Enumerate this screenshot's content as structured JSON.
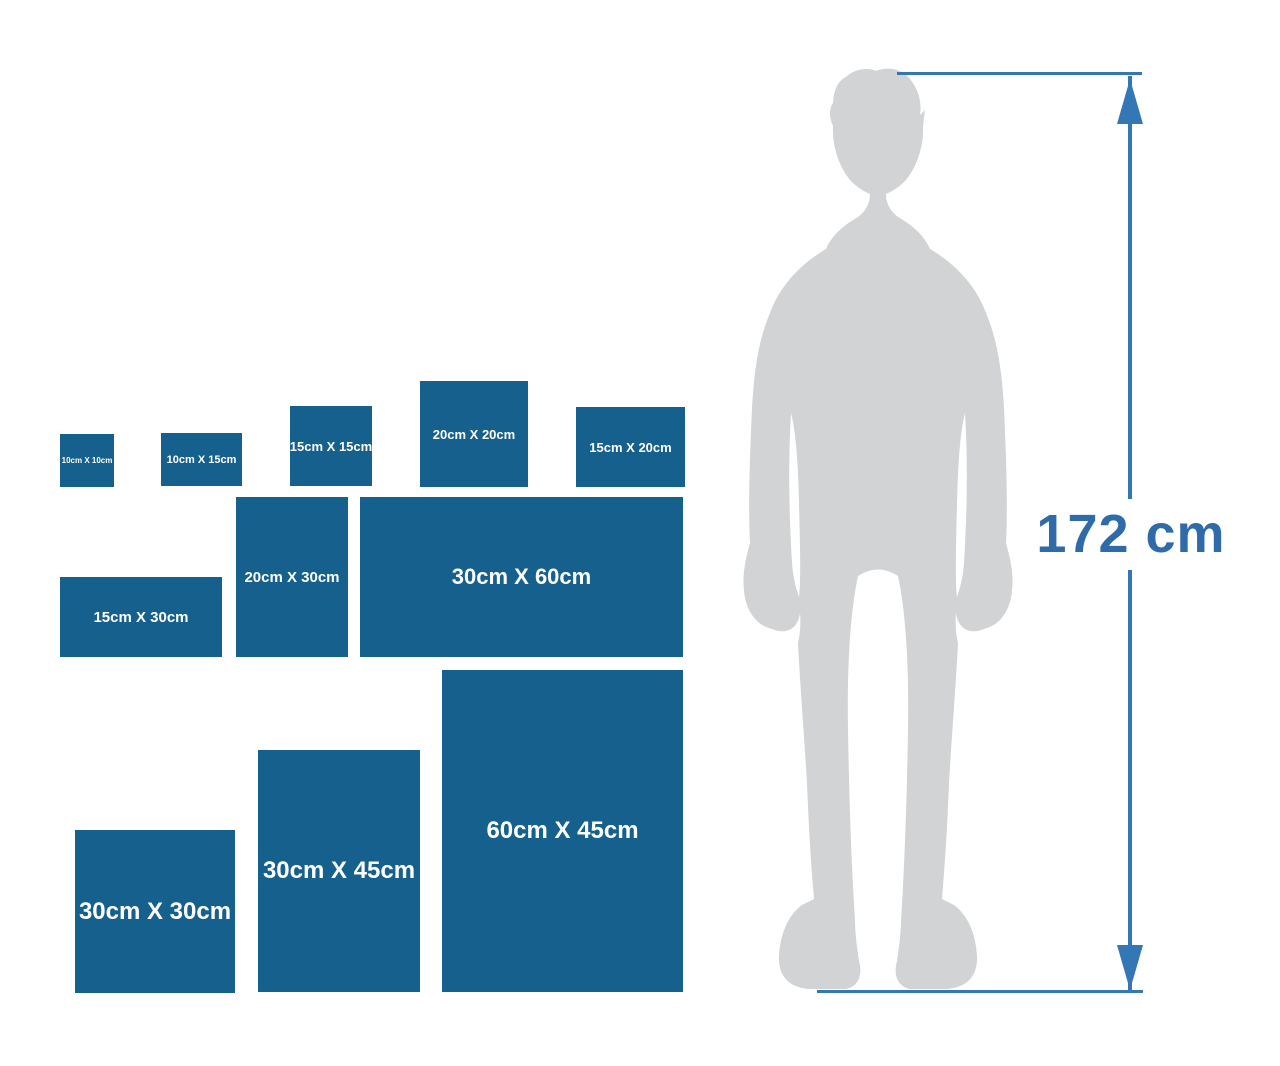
{
  "title": "Size comparison diagram",
  "colors": {
    "background": "#ffffff",
    "box_blue": "#15608D",
    "box_label_white": "#ffffff",
    "silhouette_gray": "#D1D3D4",
    "arrow_blue": "#3377B4",
    "height_text_blue": "#2E6BA8"
  },
  "boxes": [
    {
      "label": "10cm X 10cm",
      "width_cm": 10,
      "height_cm": 10
    },
    {
      "label": "10cm X 15cm",
      "width_cm": 15,
      "height_cm": 10
    },
    {
      "label": "15cm X 15cm",
      "width_cm": 15,
      "height_cm": 15
    },
    {
      "label": "20cm X 20cm",
      "width_cm": 20,
      "height_cm": 20
    },
    {
      "label": "15cm X 20cm",
      "width_cm": 20,
      "height_cm": 15
    },
    {
      "label": "15cm X 30cm",
      "width_cm": 30,
      "height_cm": 15
    },
    {
      "label": "20cm X 30cm",
      "width_cm": 20,
      "height_cm": 30
    },
    {
      "label": "30cm X 60cm",
      "width_cm": 60,
      "height_cm": 30
    },
    {
      "label": "30cm X 30cm",
      "width_cm": 30,
      "height_cm": 30
    },
    {
      "label": "30cm X 45cm",
      "width_cm": 30,
      "height_cm": 45
    },
    {
      "label": "60cm X 45cm",
      "width_cm": 45,
      "height_cm": 60
    }
  ],
  "person": {
    "height_label": "172 cm"
  }
}
